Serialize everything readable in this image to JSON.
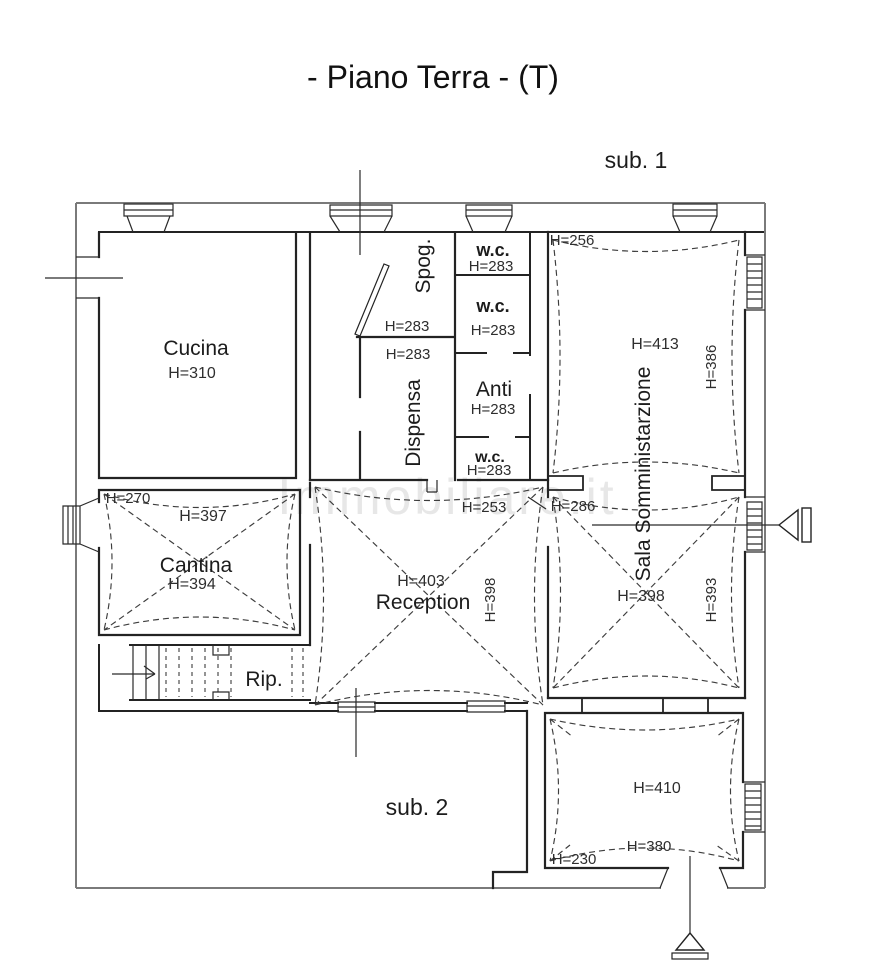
{
  "title": "- Piano Terra - (T)",
  "labels": {
    "sub1": "sub. 1",
    "sub2": "sub. 2"
  },
  "watermark": "Immobiliare.it",
  "rooms": {
    "cucina": {
      "name": "Cucina",
      "h": "H=310"
    },
    "spog": {
      "name": "Spog.",
      "h": "H=283"
    },
    "dispensa": {
      "name": "Dispensa",
      "h": "H=283"
    },
    "wc_top": {
      "name": "w.c.",
      "h": "H=283"
    },
    "wc_mid": {
      "name": "w.c.",
      "h": "H=283"
    },
    "anti": {
      "name": "Anti",
      "h": "H=283"
    },
    "wc_low": {
      "name": "w.c.",
      "h": "H=283"
    },
    "sala": {
      "name": "Sala Somministarzione",
      "h_corner": "H=256",
      "h_upper": "H=413",
      "h_upper_right": "H=386",
      "h_door": "H=286",
      "h_lower": "H=398",
      "h_lower_right": "H=393"
    },
    "reception": {
      "name": "Reception",
      "h_door": "H=253",
      "h": "H=403",
      "h_right": "H=398"
    },
    "cantina": {
      "name": "Cantina",
      "h_corner": "H=270",
      "h_top": "H=397",
      "h": "H=394"
    },
    "rip": {
      "name": "Rip."
    },
    "bottom_room": {
      "h": "H=410",
      "h_lower": "H=380",
      "h_corner": "H=230"
    }
  }
}
